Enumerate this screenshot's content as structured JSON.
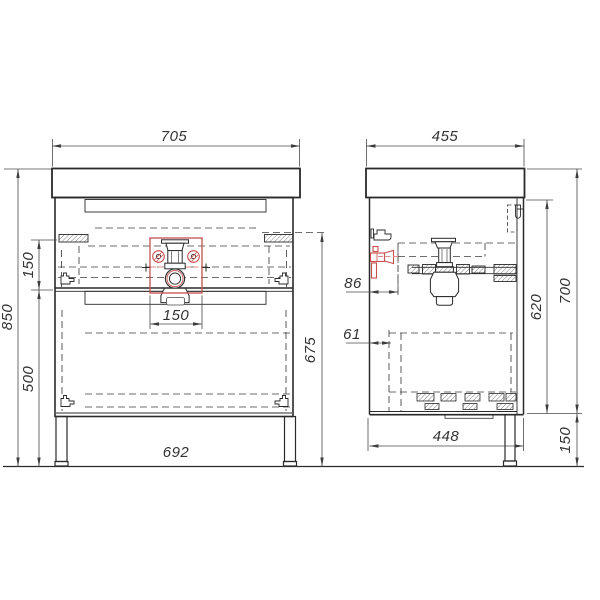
{
  "document": {
    "type": "technical-drawing",
    "subject": "bathroom vanity cabinet with basin, front and side orthographic views"
  },
  "views": {
    "front": {
      "width": "705",
      "total_height": "850",
      "slide_spacing": "150",
      "lower_section_height": "500",
      "drain_cutout_width": "150",
      "slide_height_from_floor": "675",
      "leg_span": "692"
    },
    "side": {
      "depth": "455",
      "valve_offset": "86",
      "front_clearance": "61",
      "carcass_height": "620",
      "body_height": "700",
      "bottom_depth": "448",
      "leg_height": "150"
    }
  },
  "colors": {
    "line": "#2a2a2a",
    "dimension": "#4a4a4a",
    "highlight_red": "#c7504e",
    "background": "#ffffff"
  }
}
